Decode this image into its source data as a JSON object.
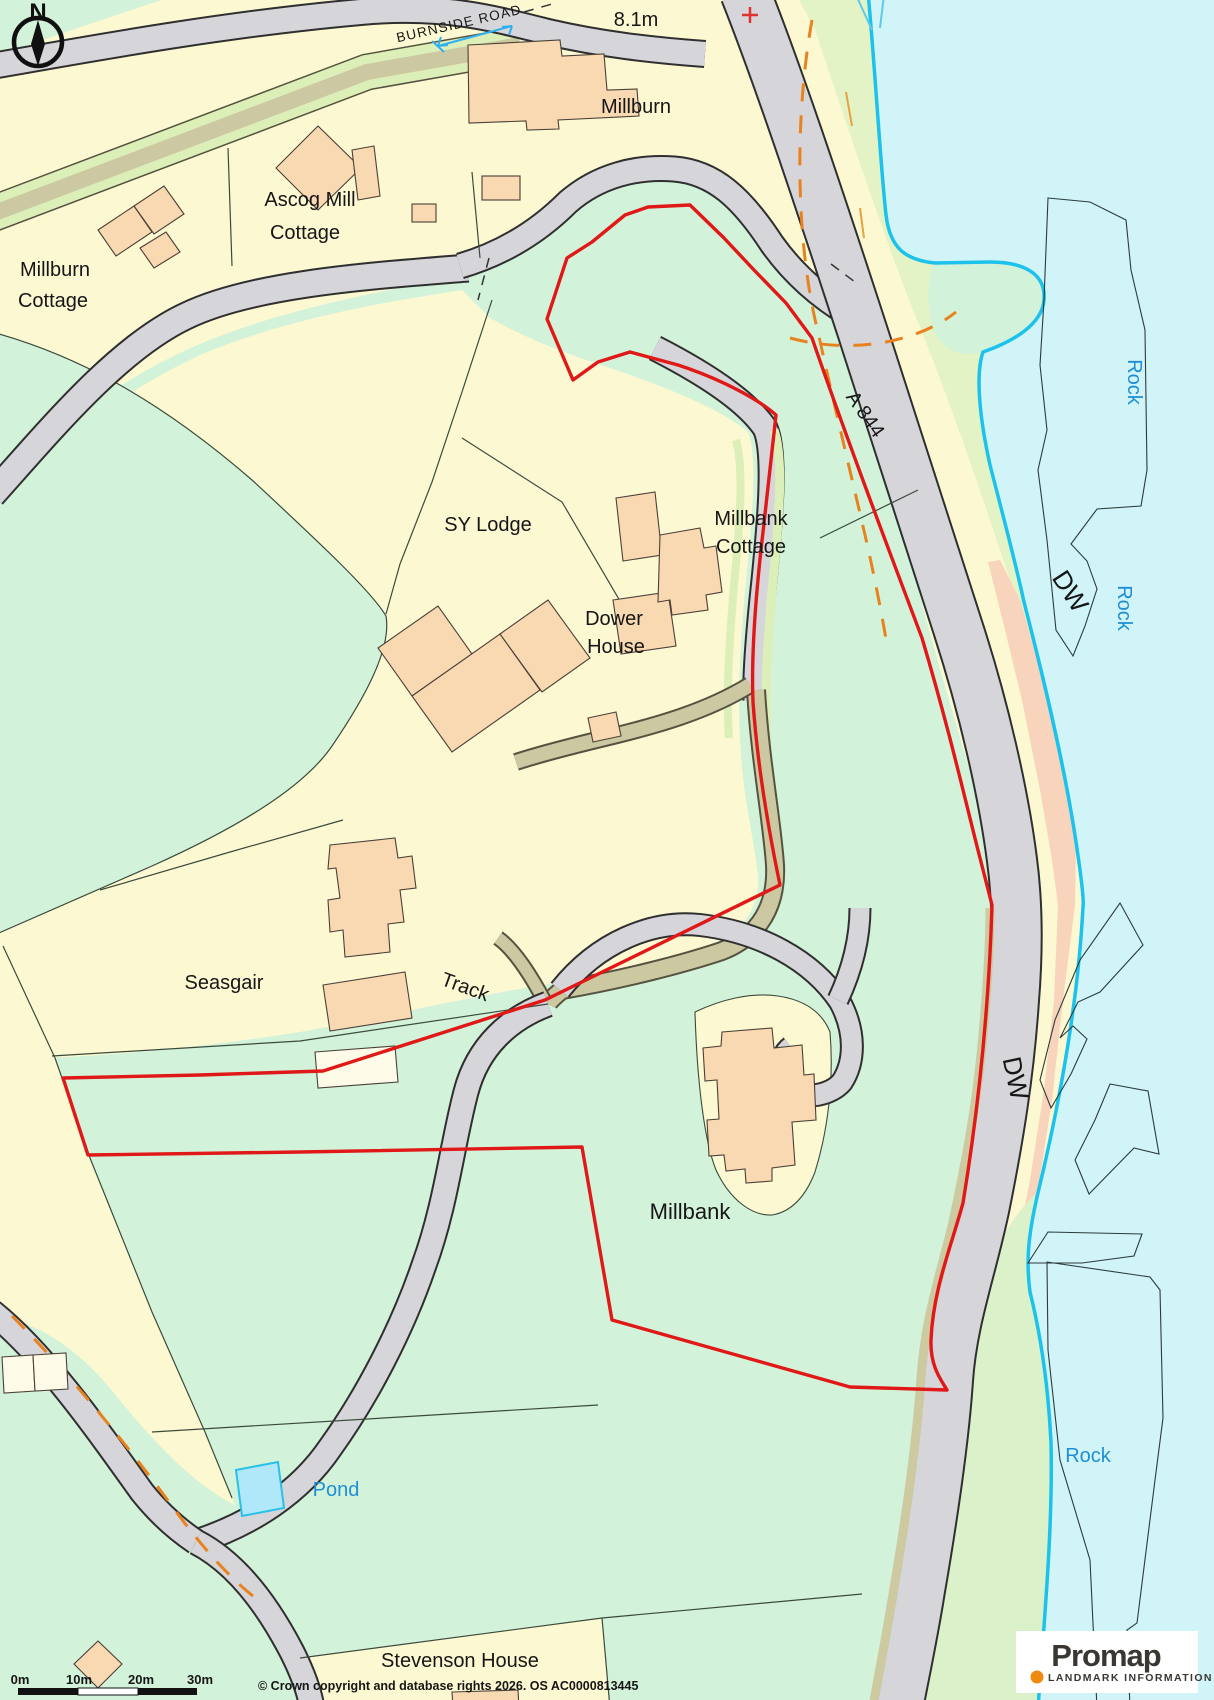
{
  "labels": {
    "burnside_road": "BURNSIDE ROAD",
    "spot_height": "8.1m",
    "millburn": "Millburn",
    "ascog_mill_1": "Ascog Mill",
    "ascog_mill_2": "Cottage",
    "millburn_cottage_1": "Millburn",
    "millburn_cottage_2": "Cottage",
    "sy_lodge": "SY Lodge",
    "millbank_cottage_1": "Millbank",
    "millbank_cottage_2": "Cottage",
    "dower_house_1": "Dower",
    "dower_house_2": "House",
    "a_road": "A 844",
    "dw": "DW",
    "rock": "Rock",
    "seasgair": "Seasgair",
    "track": "Track",
    "millbank": "Millbank",
    "pond": "Pond",
    "stevenson_house": "Stevenson House",
    "compass_north": "N"
  },
  "scale_bar": {
    "tick_0": "0m",
    "tick_1": "10m",
    "tick_2": "20m",
    "tick_3": "30m"
  },
  "attribution": {
    "copyright": "© Crown copyright and database rights 2026. OS AC0000813445"
  },
  "logo": {
    "brand": "Promap",
    "tagline": "LANDMARK INFORMATION"
  },
  "colors": {
    "site_boundary_red": "#e01818",
    "sea_fill": "#d0f4f7",
    "waterline_cyan": "#1cc2ec",
    "road_fill": "#d6d5da",
    "building_peach": "#f9d9b2",
    "field_green": "#d3f2da",
    "parcel_yellow": "#fcf8d2",
    "shore_green": "#e3f3c5",
    "foreshore_salmon": "#f8d4bc",
    "track_khaki": "#cbc8a2",
    "path_orange": "#e8821e",
    "water_label_blue": "#1e8fd6",
    "logo_dot_orange": "#f08a10"
  }
}
